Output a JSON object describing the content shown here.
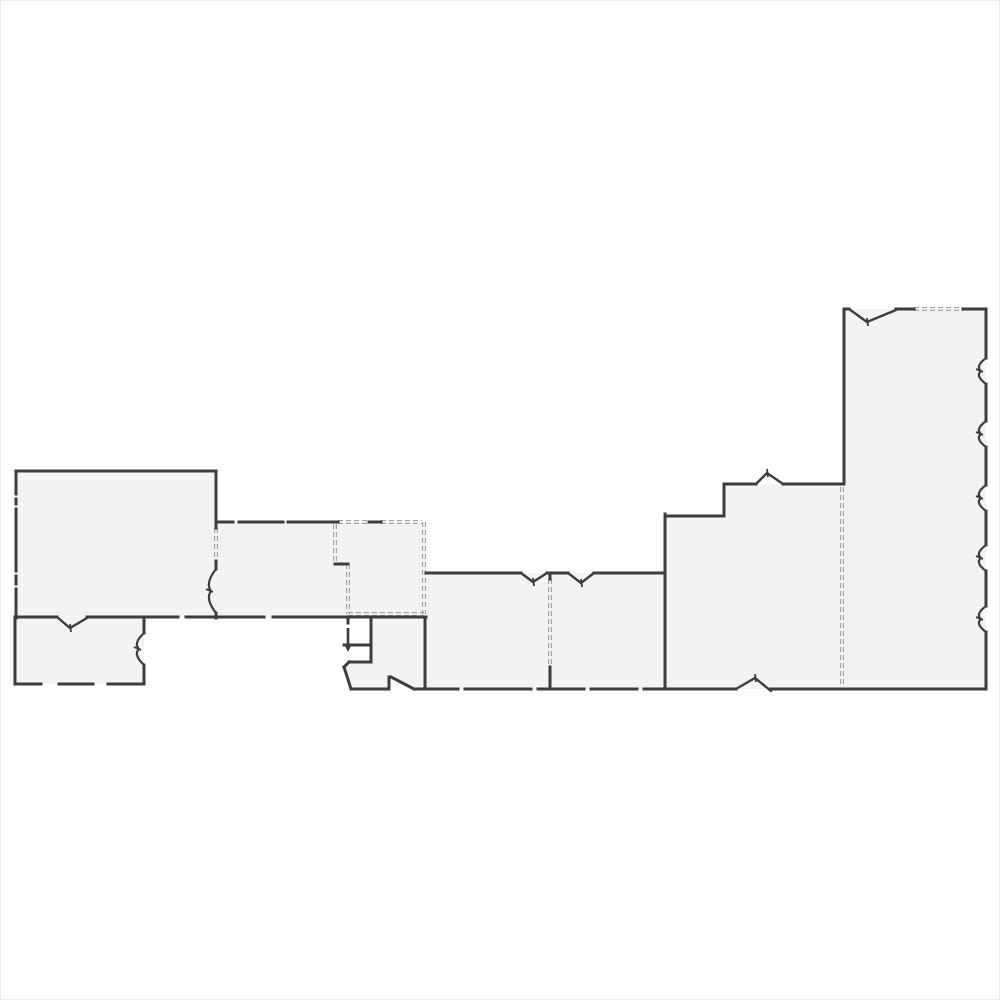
{
  "floorplan": {
    "canvas": {
      "width": 1000,
      "height": 1000,
      "background": "#ffffff",
      "border_color": "#ececec"
    },
    "colors": {
      "floor": "#f3f3f1",
      "wall": "#3d3d3d",
      "dashed": "#9f9f9f"
    },
    "rooms": [
      {
        "name": "room-large-left",
        "points": [
          [
            15,
            470
          ],
          [
            215,
            470
          ],
          [
            215,
            616
          ],
          [
            15,
            616
          ]
        ]
      },
      {
        "name": "room-bottom-left",
        "points": [
          [
            14,
            616
          ],
          [
            143,
            616
          ],
          [
            143,
            683
          ],
          [
            14,
            683
          ]
        ]
      },
      {
        "name": "room-middle-left",
        "points": [
          [
            215,
            521
          ],
          [
            425,
            521
          ],
          [
            425,
            616
          ],
          [
            215,
            616
          ]
        ]
      },
      {
        "name": "room-vestibule",
        "points": [
          [
            370,
            617
          ],
          [
            425,
            617
          ],
          [
            425,
            688
          ],
          [
            413,
            688
          ],
          [
            390,
            677
          ],
          [
            388,
            677
          ],
          [
            388,
            688
          ],
          [
            350,
            688
          ],
          [
            343,
            666
          ],
          [
            348,
            661
          ],
          [
            370,
            661
          ]
        ]
      },
      {
        "name": "room-middle",
        "points": [
          [
            425,
            572
          ],
          [
            663,
            572
          ],
          [
            663,
            688
          ],
          [
            425,
            688
          ]
        ]
      },
      {
        "name": "room-right-section",
        "points": [
          [
            664,
            515
          ],
          [
            723,
            515
          ],
          [
            723,
            483
          ],
          [
            843,
            483
          ],
          [
            843,
            308
          ],
          [
            985,
            308
          ],
          [
            985,
            688
          ],
          [
            664,
            688
          ]
        ]
      }
    ],
    "solid_walls": [
      [
        15,
        470,
        215,
        470
      ],
      [
        15,
        470,
        15,
        493
      ],
      [
        15,
        498,
        15,
        503
      ],
      [
        15,
        508,
        15,
        570
      ],
      [
        15,
        575,
        15,
        583
      ],
      [
        15,
        588,
        15,
        617
      ],
      [
        215,
        470,
        215,
        527
      ],
      [
        215,
        560,
        215,
        568
      ],
      [
        215,
        612,
        215,
        617
      ],
      [
        15,
        616,
        56,
        616
      ],
      [
        86,
        616,
        177,
        616
      ],
      [
        185,
        616,
        263,
        616
      ],
      [
        272,
        616,
        425,
        616
      ],
      [
        14,
        616,
        14,
        683
      ],
      [
        14,
        683,
        40,
        683
      ],
      [
        58,
        683,
        92,
        683
      ],
      [
        107,
        683,
        143,
        683
      ],
      [
        143,
        616,
        143,
        632
      ],
      [
        143,
        664,
        143,
        683
      ],
      [
        215,
        521,
        232,
        521
      ],
      [
        238,
        521,
        282,
        521
      ],
      [
        287,
        521,
        337,
        521
      ],
      [
        368,
        521,
        380,
        521
      ],
      [
        334,
        563,
        347,
        563
      ],
      [
        347,
        616,
        347,
        622
      ],
      [
        370,
        617,
        370,
        661
      ],
      [
        343,
        644,
        370,
        644
      ],
      [
        348,
        661,
        370,
        661
      ],
      [
        343,
        666,
        348,
        661
      ],
      [
        343,
        666,
        350,
        688
      ],
      [
        350,
        688,
        388,
        688
      ],
      [
        388,
        676,
        388,
        688
      ],
      [
        390,
        676,
        413,
        688
      ],
      [
        424,
        616,
        424,
        688
      ],
      [
        425,
        572,
        520,
        572
      ],
      [
        546,
        572,
        567,
        572
      ],
      [
        593,
        572,
        663,
        572
      ],
      [
        549,
        572,
        549,
        578
      ],
      [
        549,
        666,
        549,
        688
      ],
      [
        664,
        513,
        664,
        688
      ],
      [
        664,
        515,
        723,
        515
      ],
      [
        723,
        483,
        723,
        515
      ],
      [
        723,
        483,
        755,
        483
      ],
      [
        782,
        483,
        843,
        483
      ],
      [
        843,
        308,
        843,
        483
      ],
      [
        843,
        308,
        848,
        308
      ],
      [
        895,
        308,
        913,
        308
      ],
      [
        962,
        308,
        985,
        308
      ],
      [
        985,
        308,
        985,
        357
      ],
      [
        985,
        383,
        985,
        420
      ],
      [
        985,
        446,
        985,
        484
      ],
      [
        985,
        510,
        985,
        544
      ],
      [
        985,
        570,
        985,
        605
      ],
      [
        985,
        631,
        985,
        688
      ],
      [
        413,
        688,
        457,
        688
      ],
      [
        464,
        688,
        530,
        688
      ],
      [
        537,
        688,
        583,
        688
      ],
      [
        590,
        688,
        636,
        688
      ],
      [
        643,
        688,
        735,
        688
      ],
      [
        770,
        688,
        985,
        688
      ]
    ],
    "dashed_walls": [
      [
        215,
        527,
        215,
        560
      ],
      [
        337,
        521,
        368,
        521
      ],
      [
        380,
        521,
        421,
        521
      ],
      [
        334,
        523,
        334,
        562
      ],
      [
        347,
        563,
        347,
        613
      ],
      [
        423,
        521,
        423,
        613
      ],
      [
        347,
        613,
        423,
        613
      ],
      [
        549,
        578,
        549,
        666
      ],
      [
        841,
        486,
        841,
        686
      ],
      [
        913,
        308,
        962,
        308
      ]
    ],
    "door_chevrons": [
      {
        "points": [
          [
            56,
            616
          ],
          [
            69,
            627
          ],
          [
            86,
            617
          ]
        ]
      },
      {
        "points": [
          [
            520,
            572
          ],
          [
            532,
            581
          ],
          [
            546,
            572
          ]
        ]
      },
      {
        "points": [
          [
            567,
            572
          ],
          [
            580,
            582
          ],
          [
            593,
            572
          ]
        ]
      },
      {
        "points": [
          [
            755,
            483
          ],
          [
            766,
            472
          ],
          [
            782,
            483
          ]
        ]
      },
      {
        "points": [
          [
            735,
            688
          ],
          [
            754,
            677
          ],
          [
            770,
            690
          ]
        ]
      },
      {
        "points": [
          [
            848,
            308
          ],
          [
            866,
            321
          ],
          [
            895,
            309
          ]
        ]
      }
    ],
    "wall_squiggles": [
      {
        "x": 215,
        "y1": 568,
        "y2": 612
      },
      {
        "x": 143,
        "y1": 632,
        "y2": 664
      },
      {
        "x": 985,
        "y1": 357,
        "y2": 383
      },
      {
        "x": 985,
        "y1": 420,
        "y2": 446
      },
      {
        "x": 985,
        "y1": 484,
        "y2": 510
      },
      {
        "x": 985,
        "y1": 544,
        "y2": 570
      },
      {
        "x": 985,
        "y1": 605,
        "y2": 631
      }
    ],
    "door_leaf": {
      "x": 347,
      "y_top": 627,
      "y_bottom": 646
    }
  }
}
